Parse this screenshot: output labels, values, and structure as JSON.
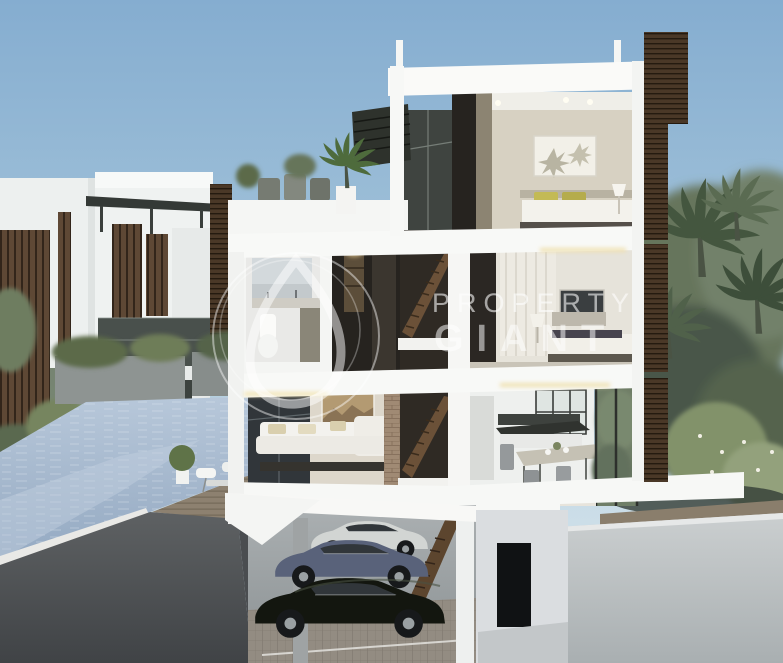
{
  "scene": {
    "type": "architectural-cutaway-render",
    "description": "Sectional 3D rendering of a four-storey cluster villa with roof terrace, lap pool, tropical landscaping and a basement garage holding three cars",
    "cars": [
      {
        "position": "rear",
        "color_name": "white"
      },
      {
        "position": "middle",
        "color_name": "slate-blue"
      },
      {
        "position": "front",
        "color_name": "black"
      }
    ]
  },
  "watermark": {
    "brand_top": "PROPERTY",
    "brand_bottom": "GIANT"
  },
  "palette": {
    "sky_top": "#85ADD0",
    "sky_horizon": "#D8E4EB",
    "cut_wall_white": "#F7F8F6",
    "interior_beige": "#D7D1C2",
    "louver_brown": "#4A3827",
    "pool_water": "#A9BDD2",
    "deck_wood": "#8D8170",
    "foliage_green": "#5C6B52",
    "palm_green": "#44563F",
    "ground_section_gray": "#515456",
    "garage_gray": "#A3A8AB",
    "car_white": "#D2D5D3",
    "car_blue": "#59627A",
    "car_black": "#13160F",
    "pillow_yellow": "#C3BA55"
  }
}
